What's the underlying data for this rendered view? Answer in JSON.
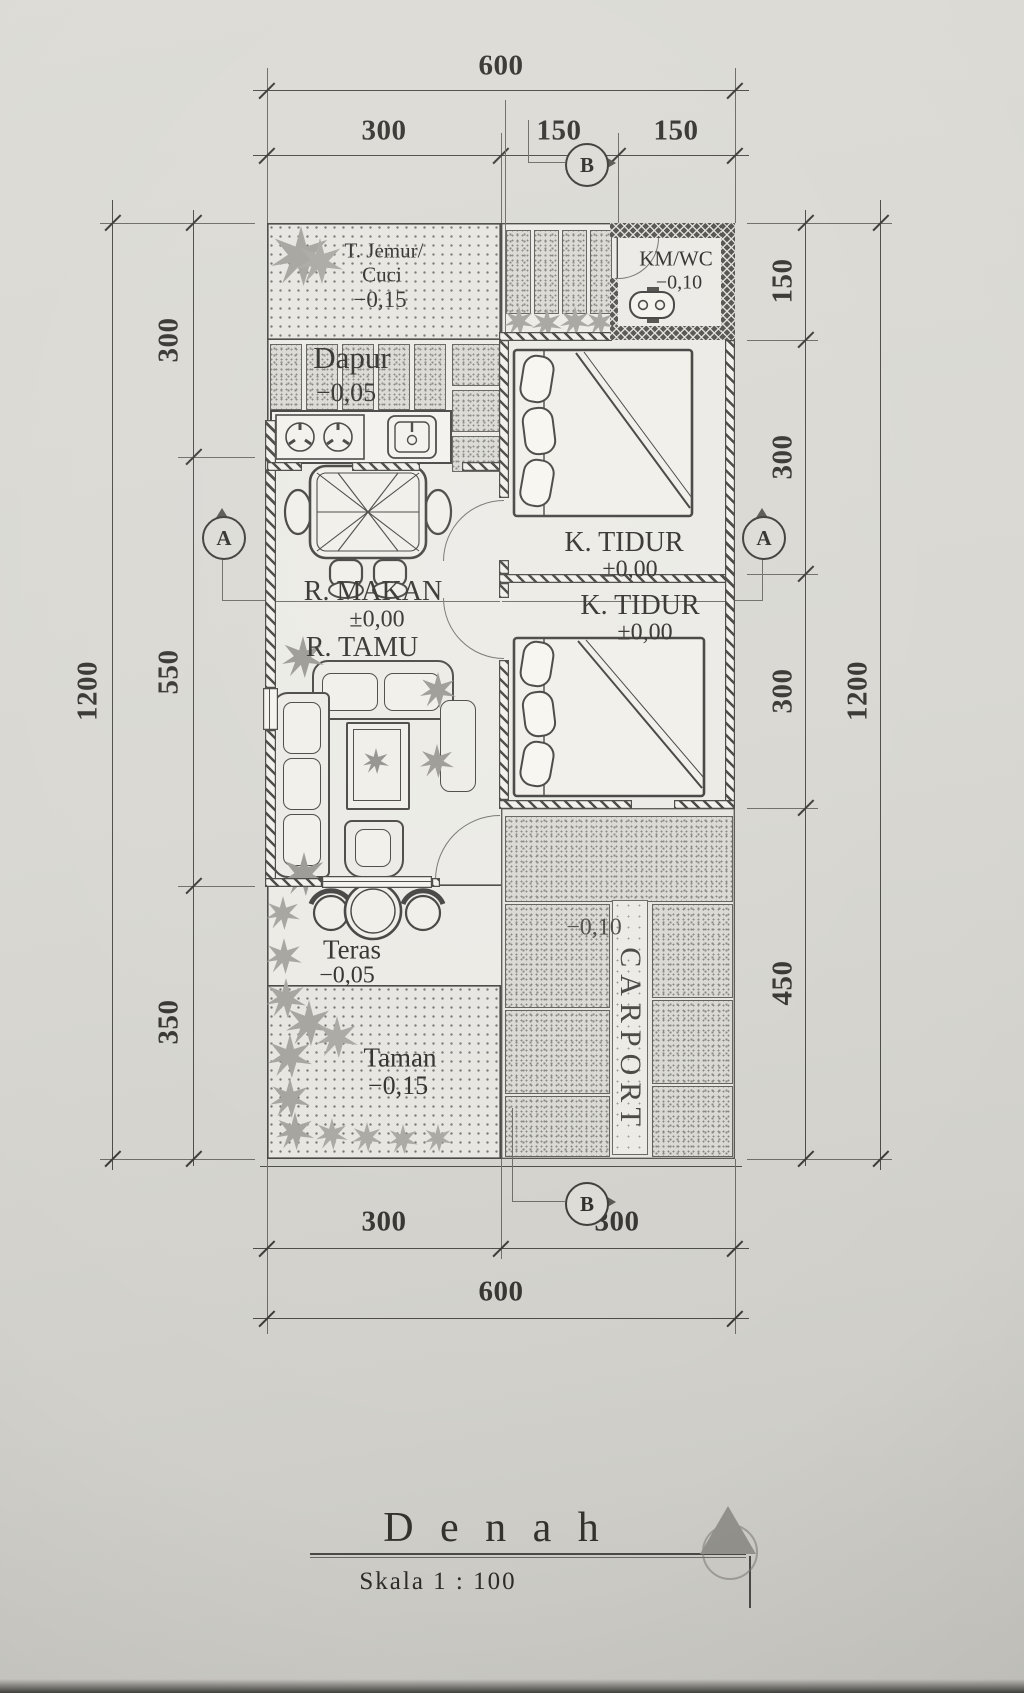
{
  "title": {
    "main": "D e n a h",
    "scale": "Skala   1  :  100"
  },
  "markers": {
    "a": "A",
    "b": "B"
  },
  "dims": {
    "top_total": "600",
    "top_seg": [
      "300",
      "150",
      "150"
    ],
    "bottom_seg": [
      "300",
      "300"
    ],
    "bottom_total": "600",
    "left_outer": "1200",
    "left_seg": [
      "300",
      "550",
      "350"
    ],
    "right_seg": [
      "150",
      "300",
      "300",
      "450"
    ],
    "right_outer": "1200"
  },
  "rooms": {
    "jemur": {
      "line1": "T. Jemur/",
      "line2": "Cuci",
      "level": "−0,15"
    },
    "dapur": {
      "name": "Dapur",
      "level": "−0,05"
    },
    "kmwc": {
      "name": "KM/WC",
      "level": "−0,10"
    },
    "tidur1": {
      "name": "K. TIDUR",
      "level": "±0,00"
    },
    "tidur2": {
      "name": "K. TIDUR",
      "level": "±0,00"
    },
    "makan": {
      "name": "R. MAKAN",
      "level": "±0,00"
    },
    "tamu": {
      "name": "R. TAMU"
    },
    "teras": {
      "name": "Teras",
      "level": "−0,05"
    },
    "taman": {
      "name": "Taman",
      "level": "−0,15"
    },
    "carport": {
      "name": "CARPORT",
      "level": "−0,10"
    }
  }
}
